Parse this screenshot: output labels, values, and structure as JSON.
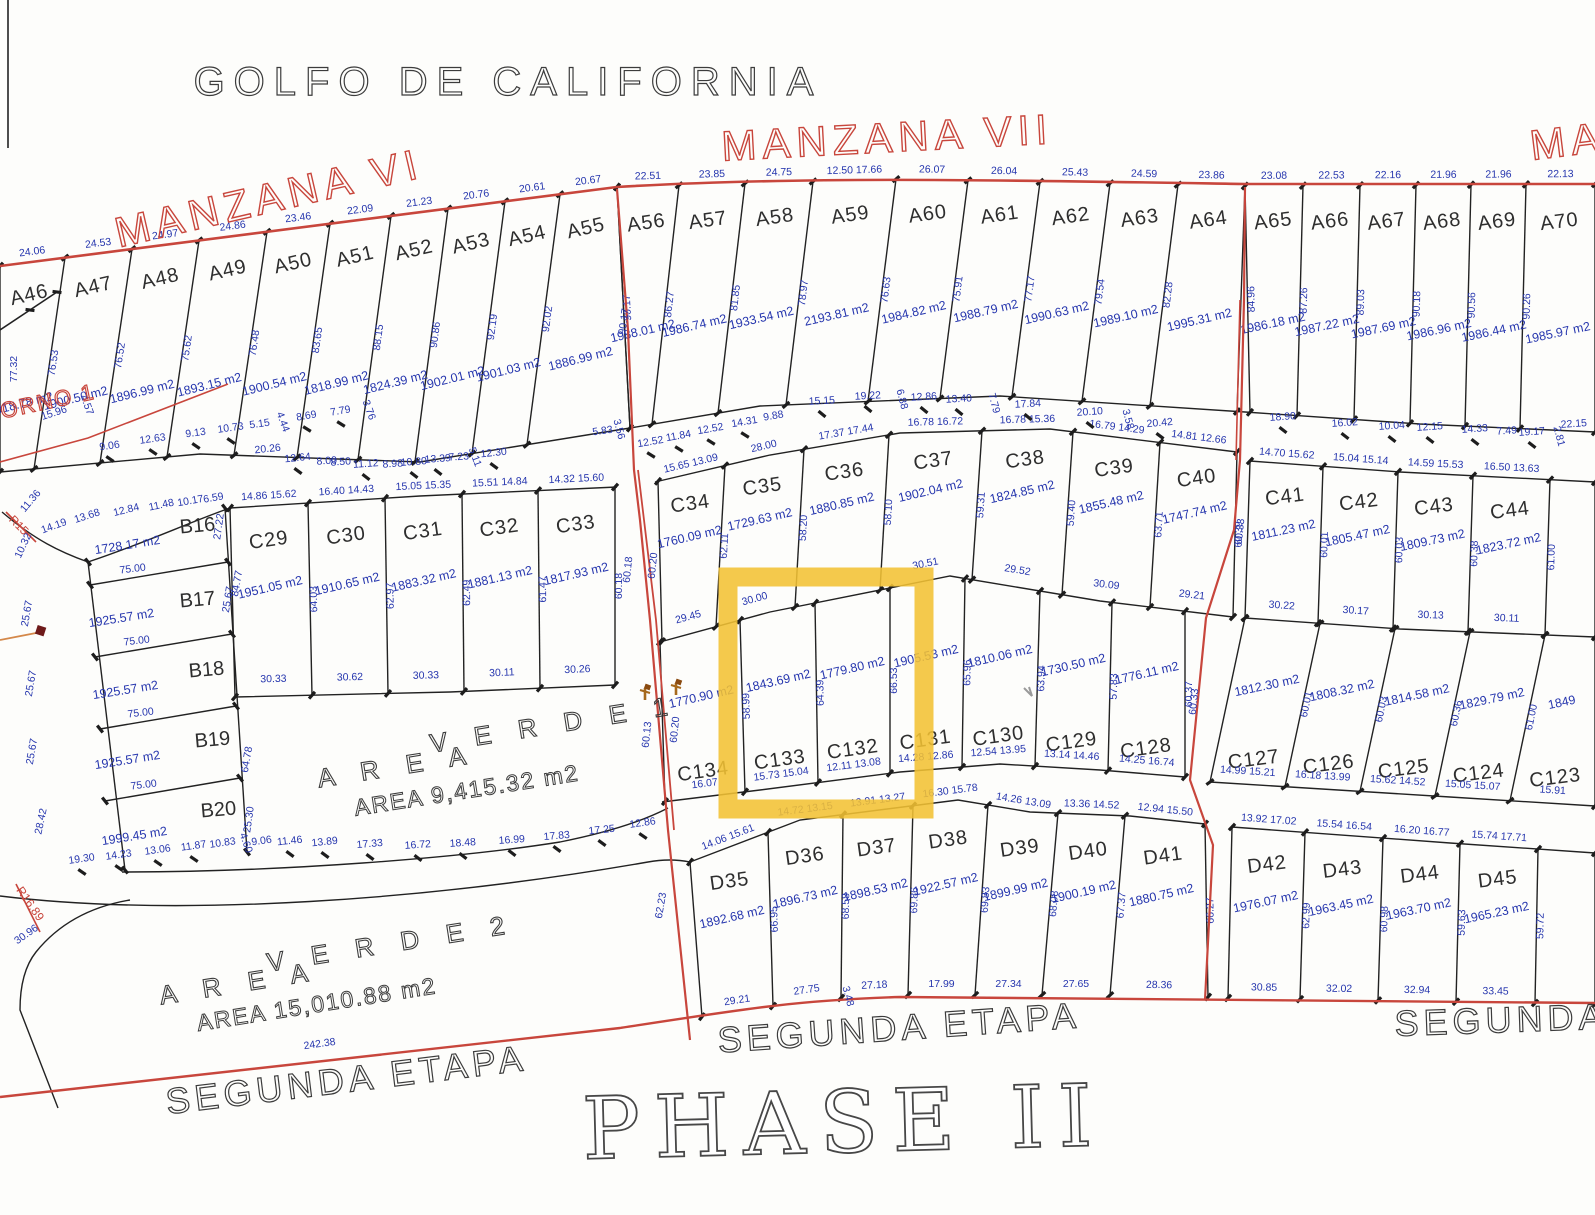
{
  "titles": {
    "golfo": "GOLFO DE CALIFORNIA",
    "manzana_vi": "MANZANA VI",
    "manzana_vii": "MANZANA VII",
    "manzana_right_partial": "MANZA",
    "retorno_partial": "TORNO 1",
    "r15": "R15",
    "r16": "R16.89",
    "area_verde1_word1": "A R E A",
    "area_verde1_word2": "V E R D E 1",
    "area_verde1_area": "AREA 9,415.32 m2",
    "area_verde2_word1": "A R E A",
    "area_verde2_word2": "V E R D E 2",
    "area_verde2_area": "AREA 15,010.88 m2",
    "segunda_left": "SEGUNDA ETAPA",
    "segunda_center": "SEGUNDA ETAPA",
    "segunda_right": "SEGUNDA ETA",
    "phase": "PHASE II"
  },
  "colors": {
    "red": "#c8463c",
    "blue": "#2636ae",
    "black": "#2b2b2b",
    "yellow": "#F2C233",
    "paper": "#fdfdfb"
  },
  "highlight": {
    "note": "yellow selection around lots C133 / C132",
    "color": "#F2C233"
  },
  "lots": {
    "a_left": [
      {
        "id": "A46",
        "top": "24.06",
        "side": "77.32",
        "area": "1918.78 m2"
      },
      {
        "id": "A47",
        "top": "24.53",
        "side": "76.53",
        "area": "1900.50 m2"
      },
      {
        "id": "A48",
        "top": "24.97",
        "side": "76.52",
        "area": "1896.99 m2"
      },
      {
        "id": "A49",
        "top": "24.86",
        "side": "75.62",
        "area": "1893.15 m2"
      },
      {
        "id": "A50",
        "top": "23.46",
        "side": "76.48",
        "area": "1900.54 m2"
      },
      {
        "id": "A51",
        "top": "22.09",
        "side": "83.65",
        "area": "1818.99 m2"
      },
      {
        "id": "A52",
        "top": "21.23",
        "side": "88.15",
        "area": "1824.39 m2"
      },
      {
        "id": "A53",
        "top": "20.76",
        "side": "90.86",
        "area": "1902.01 m2"
      },
      {
        "id": "A54",
        "top": "20.61",
        "side": "92.19",
        "area": "1901.03 m2"
      },
      {
        "id": "A55",
        "top": "20.67",
        "side": "92.02",
        "area": "1886.99 m2"
      }
    ],
    "a_mid": [
      {
        "id": "A56",
        "top": "22.51",
        "side": "90.17",
        "area": "1988.01 m2"
      },
      {
        "id": "A57",
        "top": "23.85",
        "side": "86.27",
        "area": "1986.74 m2"
      },
      {
        "id": "A58",
        "top": "24.75",
        "side": "81.85",
        "area": "1933.54 m2"
      },
      {
        "id": "A59",
        "top": "12.50 17.66",
        "side": "78.97",
        "area": "2193.81 m2"
      },
      {
        "id": "A60",
        "top": "26.07",
        "side": "76.63",
        "area": "1984.82 m2"
      },
      {
        "id": "A61",
        "top": "26.04",
        "side": "75.91",
        "area": "1988.79 m2"
      },
      {
        "id": "A62",
        "top": "25.43",
        "side": "77.17",
        "area": "1990.63 m2"
      },
      {
        "id": "A63",
        "top": "24.59",
        "side": "79.54",
        "area": "1989.10 m2"
      },
      {
        "id": "A64",
        "top": "23.86",
        "side": "82.28",
        "area": "1995.31 m2"
      }
    ],
    "a_right": [
      {
        "id": "A65",
        "top": "23.08",
        "side": "84.96",
        "area": "1986.18 m2"
      },
      {
        "id": "A66",
        "top": "22.53",
        "side": "87.26",
        "area": "1987.22 m2"
      },
      {
        "id": "A67",
        "top": "22.16",
        "side": "89.03",
        "area": "1987.69 m2"
      },
      {
        "id": "A68",
        "top": "21.96",
        "side": "90.18",
        "area": "1986.96 m2"
      },
      {
        "id": "A69",
        "top": "21.96",
        "side": "90.56",
        "area": "1986.44 m2"
      },
      {
        "id": "A70",
        "top": "22.13",
        "side": "90.26",
        "area": "1985.97 m2"
      }
    ],
    "b_block": [
      {
        "id": "B16",
        "area": "1728.17 m2",
        "side": "27.22",
        "bottom": "75.00"
      },
      {
        "id": "B17",
        "area": "1925.57 m2",
        "side": "25.67",
        "bottom": "75.00"
      },
      {
        "id": "B18",
        "area": "1925.57 m2",
        "side": "25.67",
        "bottom": "75.00"
      },
      {
        "id": "B19",
        "area": "1925.57 m2",
        "side": "25.67",
        "bottom": "75.00"
      },
      {
        "id": "B20",
        "area": "1999.45 m2",
        "side": "25.30",
        "bottom": ""
      }
    ],
    "c_upper_left": [
      {
        "id": "C29",
        "top": "14.86 15.62",
        "side": "64.03",
        "area": "1951.05 m2",
        "bottom": "30.33"
      },
      {
        "id": "C30",
        "top": "16.40 14.43",
        "side": "62.97",
        "area": "1910.65 m2",
        "bottom": "30.62"
      },
      {
        "id": "C31",
        "top": "15.05 15.35",
        "side": "62.49",
        "area": "1883.32 m2",
        "bottom": "30.33"
      },
      {
        "id": "C32",
        "top": "15.51 14.84",
        "side": "61.47",
        "area": "1881.13 m2",
        "bottom": "30.11"
      },
      {
        "id": "C33",
        "top": "14.32 15.60",
        "side": "60.18",
        "area": "1817.93 m2",
        "bottom": "30.26"
      }
    ],
    "c_upper_mid": [
      {
        "id": "C34",
        "top": "15.65 13.09",
        "side": "62.11",
        "area": "1760.09 m2",
        "bottom": "29.45"
      },
      {
        "id": "C35",
        "top": "28.00",
        "side": "58.20",
        "area": "1729.63 m2",
        "bottom": "30.00"
      },
      {
        "id": "C36",
        "top": "17.37 17.44",
        "side": "58.10",
        "area": "1880.85 m2",
        "bottom": ""
      },
      {
        "id": "C37",
        "top": "16.78 16.72",
        "side": "59.31",
        "area": "1902.04 m2",
        "bottom": "30.51"
      },
      {
        "id": "C38",
        "top": "16.78 15.36",
        "side": "59.40",
        "area": "1824.85 m2",
        "bottom": "29.52"
      },
      {
        "id": "C39",
        "top": "16.79 14.29",
        "side": "63.71",
        "area": "1855.48 m2",
        "bottom": "30.09"
      },
      {
        "id": "C40",
        "top": "14.81 12.66",
        "side": "60.39",
        "area": "1747.74 m2",
        "bottom": "29.21"
      }
    ],
    "c_upper_right": [
      {
        "id": "C41",
        "top": "14.70 15.62",
        "side": "60.01",
        "area": "1811.23 m2",
        "bottom": "30.22"
      },
      {
        "id": "C42",
        "top": "15.04 15.14",
        "side": "60.03",
        "area": "1805.47 m2",
        "bottom": "30.17"
      },
      {
        "id": "C43",
        "top": "14.59 15.53",
        "side": "60.38",
        "area": "1809.73 m2",
        "bottom": "30.13"
      },
      {
        "id": "C44",
        "top": "16.50 13.63",
        "side": "61.00",
        "area": "1823.72 m2",
        "bottom": "30.11"
      },
      {
        "id": "",
        "top": "",
        "side": "",
        "area": "",
        "bottom": ""
      }
    ],
    "c_lower_mid": [
      {
        "id": "C134",
        "top": "",
        "side": "58.99",
        "area": "1770.90 m2",
        "bottom": "16.07"
      },
      {
        "id": "C133",
        "top": "",
        "side": "64.39",
        "area": "1843.69 m2",
        "bottom": "15.73 15.04"
      },
      {
        "id": "C132",
        "top": "",
        "side": "66.53",
        "area": "1779.80 m2",
        "bottom": "12.11 13.08"
      },
      {
        "id": "C131",
        "top": "",
        "side": "65.96",
        "area": "1905.53 m2",
        "bottom": "14.28 12.86"
      },
      {
        "id": "C130",
        "top": "",
        "side": "63.94",
        "area": "1810.06 m2",
        "bottom": "12.54 13.95"
      },
      {
        "id": "C129",
        "top": "",
        "side": "57.83",
        "area": "1730.50 m2",
        "bottom": "13.14 14.46"
      },
      {
        "id": "C128",
        "top": "",
        "side": "60.37",
        "area": "1776.11 m2",
        "bottom": "14.25 16.74"
      }
    ],
    "c_lower_right": [
      {
        "id": "C127",
        "top": "",
        "side": "60.01",
        "area": "1812.30 m2",
        "bottom": "14.99 15.21"
      },
      {
        "id": "C126",
        "top": "",
        "side": "60.03",
        "area": "1808.32 m2",
        "bottom": "16.18 13.99"
      },
      {
        "id": "C125",
        "top": "",
        "side": "60.36",
        "area": "1814.58 m2",
        "bottom": "15.62 14.52"
      },
      {
        "id": "C124",
        "top": "",
        "side": "61.00",
        "area": "1829.79 m2",
        "bottom": "15.05 15.07"
      },
      {
        "id": "C123",
        "top": "",
        "side": "",
        "area": "1849",
        "bottom": "15.91"
      }
    ],
    "d_left": [
      {
        "id": "D35",
        "top": "14.06 15.61",
        "side": "66.95",
        "area": "1892.68 m2",
        "bottom": "29.21"
      },
      {
        "id": "D36",
        "top": "14.72 13.15",
        "side": "68.58",
        "area": "1896.73 m2",
        "bottom": "27.75"
      },
      {
        "id": "D37",
        "top": "13.91 13.27",
        "side": "69.86",
        "area": "1898.53 m2",
        "bottom": "27.18"
      },
      {
        "id": "D38",
        "top": "16.30 15.78",
        "side": "69.83",
        "area": "1922.57 m2",
        "bottom": "17.99"
      },
      {
        "id": "D39",
        "top": "14.26 13.09",
        "side": "68.08",
        "area": "1899.99 m2",
        "bottom": "27.34"
      },
      {
        "id": "D40",
        "top": "13.36 14.52",
        "side": "67.37",
        "area": "1900.19 m2",
        "bottom": "27.65"
      },
      {
        "id": "D41",
        "top": "12.94 15.50",
        "side": "66.27",
        "area": "1880.75 m2",
        "bottom": "28.36"
      }
    ],
    "d_right": [
      {
        "id": "D42",
        "top": "13.92 17.02",
        "side": "62.99",
        "area": "1976.07 m2",
        "bottom": "30.85"
      },
      {
        "id": "D43",
        "top": "15.54 16.54",
        "side": "60.98",
        "area": "1963.45 m2",
        "bottom": "32.02"
      },
      {
        "id": "D44",
        "top": "16.20 16.77",
        "side": "59.63",
        "area": "1963.70 m2",
        "bottom": "32.94"
      },
      {
        "id": "D45",
        "top": "15.74 17.71",
        "side": "59.72",
        "area": "1965.23 m2",
        "bottom": "33.45"
      },
      {
        "id": "",
        "top": "",
        "side": "",
        "area": "",
        "bottom": ""
      }
    ]
  },
  "loose_dims": [
    {
      "t": "15.96",
      "x": 55,
      "y": 416,
      "r": -18
    },
    {
      "t": "4.57",
      "x": 84,
      "y": 406,
      "r": 70
    },
    {
      "t": "9.06",
      "x": 110,
      "y": 449,
      "r": -8,
      "k": 1
    },
    {
      "t": "12.63",
      "x": 153,
      "y": 442,
      "r": -8,
      "k": 1
    },
    {
      "t": "9.13",
      "x": 196,
      "y": 436,
      "r": -8,
      "k": 1
    },
    {
      "t": "10.73",
      "x": 231,
      "y": 431,
      "r": -8,
      "k": 1
    },
    {
      "t": "5.15",
      "x": 260,
      "y": 427,
      "r": -8
    },
    {
      "t": "4.44",
      "x": 280,
      "y": 423,
      "r": 70
    },
    {
      "t": "8.69",
      "x": 307,
      "y": 419,
      "r": -10,
      "k": 1
    },
    {
      "t": "7.79",
      "x": 341,
      "y": 414,
      "r": -10,
      "k": 1
    },
    {
      "t": "3.76",
      "x": 366,
      "y": 411,
      "r": 70
    },
    {
      "t": "20.26",
      "x": 268,
      "y": 452,
      "r": -6
    },
    {
      "t": "12.64",
      "x": 298,
      "y": 461,
      "r": -6,
      "k": 1
    },
    {
      "t": "8.00",
      "x": 327,
      "y": 464,
      "r": -4
    },
    {
      "t": "8.50",
      "x": 341,
      "y": 465,
      "r": -4
    },
    {
      "t": "11.12",
      "x": 366,
      "y": 467,
      "r": -4,
      "k": 1
    },
    {
      "t": "8.98",
      "x": 393,
      "y": 467,
      "r": -4
    },
    {
      "t": "10.80",
      "x": 414,
      "y": 465,
      "r": -4,
      "k": 1
    },
    {
      "t": "13.39",
      "x": 438,
      "y": 462,
      "r": -4,
      "k": 1
    },
    {
      "t": "7.23",
      "x": 459,
      "y": 460,
      "r": -4
    },
    {
      "t": "5.11",
      "x": 472,
      "y": 458,
      "r": 70
    },
    {
      "t": "12.30",
      "x": 494,
      "y": 456,
      "r": -6,
      "k": 1
    },
    {
      "t": "5.83",
      "x": 603,
      "y": 434,
      "r": -8
    },
    {
      "t": "3.56",
      "x": 616,
      "y": 430,
      "r": 75
    },
    {
      "t": "12.52",
      "x": 651,
      "y": 445,
      "r": -10,
      "k": 1
    },
    {
      "t": "11.84",
      "x": 679,
      "y": 439,
      "r": -10,
      "k": 1
    },
    {
      "t": "12.52",
      "x": 711,
      "y": 432,
      "r": -10,
      "k": 1
    },
    {
      "t": "14.31",
      "x": 745,
      "y": 425,
      "r": -10,
      "k": 1
    },
    {
      "t": "9.88",
      "x": 774,
      "y": 419,
      "r": -10
    },
    {
      "t": "15.15",
      "x": 822,
      "y": 404,
      "r": -3,
      "k": 1
    },
    {
      "t": "19.22",
      "x": 868,
      "y": 399,
      "r": -3,
      "k": 1
    },
    {
      "t": "6.88",
      "x": 899,
      "y": 400,
      "r": 75
    },
    {
      "t": "12.86",
      "x": 924,
      "y": 400,
      "r": -3,
      "k": 1
    },
    {
      "t": "13.40",
      "x": 959,
      "y": 402,
      "r": -3,
      "k": 1
    },
    {
      "t": "7.79",
      "x": 991,
      "y": 404,
      "r": 75
    },
    {
      "t": "17.84",
      "x": 1028,
      "y": 407,
      "r": -3,
      "k": 1
    },
    {
      "t": "20.10",
      "x": 1090,
      "y": 415,
      "r": -4,
      "k": 1
    },
    {
      "t": "3.58",
      "x": 1125,
      "y": 420,
      "r": 75
    },
    {
      "t": "20.42",
      "x": 1160,
      "y": 426,
      "r": -5,
      "k": 1
    },
    {
      "t": "18.90",
      "x": 1283,
      "y": 420,
      "r": -4,
      "k": 1
    },
    {
      "t": "16.02",
      "x": 1345,
      "y": 426,
      "r": -4,
      "k": 1
    },
    {
      "t": "10.04",
      "x": 1392,
      "y": 429,
      "r": -4,
      "k": 1
    },
    {
      "t": "12.15",
      "x": 1430,
      "y": 430,
      "r": -4,
      "k": 1
    },
    {
      "t": "14.33",
      "x": 1475,
      "y": 432,
      "r": -4,
      "k": 1
    },
    {
      "t": "7.49",
      "x": 1507,
      "y": 434,
      "r": -4
    },
    {
      "t": "19.17",
      "x": 1532,
      "y": 435,
      "r": -4,
      "k": 1
    },
    {
      "t": "2.81",
      "x": 1556,
      "y": 437,
      "r": 75
    },
    {
      "t": "22.15",
      "x": 1574,
      "y": 427,
      "r": -4
    },
    {
      "t": "90.17",
      "x": 627,
      "y": 322,
      "r": -82
    },
    {
      "t": "60.18",
      "x": 631,
      "y": 570,
      "r": -84
    },
    {
      "t": "60.20",
      "x": 656,
      "y": 566,
      "r": -84
    },
    {
      "t": "60.13",
      "x": 650,
      "y": 735,
      "r": -84
    },
    {
      "t": "60.20",
      "x": 678,
      "y": 730,
      "r": -84
    },
    {
      "t": "60.33",
      "x": 1243,
      "y": 532,
      "r": -84
    },
    {
      "t": "60.33",
      "x": 1197,
      "y": 702,
      "r": -84
    },
    {
      "t": "62.23",
      "x": 664,
      "y": 906,
      "r": -80
    },
    {
      "t": "14.19",
      "x": 55,
      "y": 529,
      "r": -20
    },
    {
      "t": "13.68",
      "x": 88,
      "y": 519,
      "r": -18
    },
    {
      "t": "12.84",
      "x": 127,
      "y": 513,
      "r": -14
    },
    {
      "t": "11.48",
      "x": 162,
      "y": 508,
      "r": -12
    },
    {
      "t": "10.17",
      "x": 191,
      "y": 504,
      "r": -10
    },
    {
      "t": "6.59",
      "x": 214,
      "y": 501,
      "r": -10
    },
    {
      "t": "10.32",
      "x": 26,
      "y": 547,
      "r": -65
    },
    {
      "t": "11.36",
      "x": 33,
      "y": 503,
      "r": -50
    },
    {
      "t": "84.77",
      "x": 240,
      "y": 584,
      "r": -80
    },
    {
      "t": "25.67",
      "x": 30,
      "y": 614,
      "r": -80
    },
    {
      "t": "25.67",
      "x": 231,
      "y": 600,
      "r": -80
    },
    {
      "t": "25.67",
      "x": 34,
      "y": 684,
      "r": -80
    },
    {
      "t": "25.67",
      "x": 35,
      "y": 752,
      "r": -80
    },
    {
      "t": "64.78",
      "x": 250,
      "y": 760,
      "r": -80
    },
    {
      "t": "28.42",
      "x": 44,
      "y": 822,
      "r": -78
    },
    {
      "t": "25.30",
      "x": 252,
      "y": 820,
      "r": -82
    },
    {
      "t": "19.30",
      "x": 82,
      "y": 862,
      "r": -8,
      "k": 1
    },
    {
      "t": "14.23",
      "x": 119,
      "y": 858,
      "r": -8,
      "k": 1
    },
    {
      "t": "13.06",
      "x": 158,
      "y": 853,
      "r": -8,
      "k": 1
    },
    {
      "t": "11.87",
      "x": 194,
      "y": 849,
      "r": -8,
      "k": 1
    },
    {
      "t": "10.83",
      "x": 223,
      "y": 846,
      "r": -8
    },
    {
      "t": "4.60",
      "x": 243,
      "y": 844,
      "r": 70
    },
    {
      "t": "9.06",
      "x": 262,
      "y": 844,
      "r": -8
    },
    {
      "t": "11.46",
      "x": 290,
      "y": 844,
      "r": -6,
      "k": 1
    },
    {
      "t": "13.89",
      "x": 325,
      "y": 845,
      "r": -6,
      "k": 1
    },
    {
      "t": "17.33",
      "x": 370,
      "y": 847,
      "r": -5,
      "k": 1
    },
    {
      "t": "16.72",
      "x": 418,
      "y": 848,
      "r": -4,
      "k": 1
    },
    {
      "t": "18.48",
      "x": 463,
      "y": 846,
      "r": -4,
      "k": 1
    },
    {
      "t": "16.99",
      "x": 512,
      "y": 843,
      "r": -4,
      "k": 1
    },
    {
      "t": "17.83",
      "x": 557,
      "y": 839,
      "r": -5,
      "k": 1
    },
    {
      "t": "17.25",
      "x": 602,
      "y": 833,
      "r": -6,
      "k": 1
    },
    {
      "t": "12.86",
      "x": 643,
      "y": 826,
      "r": -8,
      "k": 1
    },
    {
      "t": "242.38",
      "x": 320,
      "y": 1047,
      "r": -8
    },
    {
      "t": "30.96",
      "x": 28,
      "y": 937,
      "r": -35
    },
    {
      "t": "3.48",
      "x": 845,
      "y": 997,
      "r": 75
    }
  ]
}
